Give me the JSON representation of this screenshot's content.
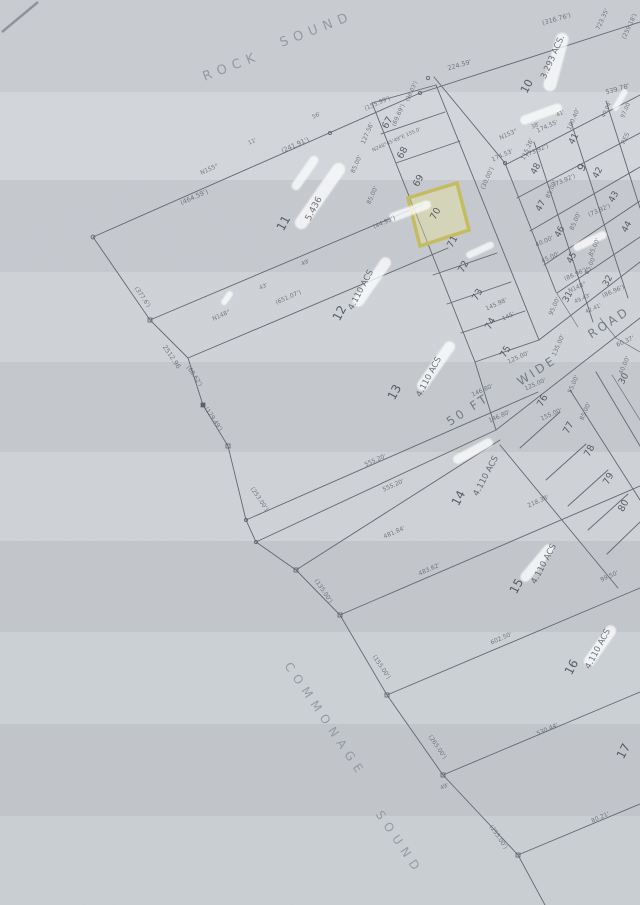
{
  "map": {
    "title": "Rock Sound subdivision survey plat (scanned)",
    "highlight": {
      "lot": "70",
      "stroke": "#c6bc5e",
      "fill": "rgba(236,230,152,0.40)"
    },
    "colors": {
      "paper": "#c9cdd2",
      "ink": "#62666e",
      "faded_ink": "#8b9198",
      "highlight": "#c6bc5e"
    },
    "labels": [
      {
        "t": "ROCK",
        "x": 233,
        "y": 70,
        "r": -21,
        "s": 13,
        "c": "water"
      },
      {
        "t": "SOUND",
        "x": 318,
        "y": 33,
        "r": -21,
        "s": 13,
        "c": "water"
      },
      {
        "t": "COMMONAGE",
        "x": 322,
        "y": 722,
        "r": 56,
        "s": 12,
        "c": "water"
      },
      {
        "t": "SOUND",
        "x": 396,
        "y": 845,
        "r": 56,
        "s": 12,
        "c": "water"
      },
      {
        "t": "11",
        "x": 287,
        "y": 225,
        "r": -62,
        "s": 12,
        "c": "lot"
      },
      {
        "t": "5.436",
        "x": 316,
        "y": 210,
        "r": -62,
        "s": 9,
        "c": "acs"
      },
      {
        "t": "12",
        "x": 343,
        "y": 315,
        "r": -62,
        "s": 12,
        "c": "lot"
      },
      {
        "t": "4.110 ACS",
        "x": 363,
        "y": 291,
        "r": -62,
        "s": 8.5,
        "c": "acs"
      },
      {
        "t": "13",
        "x": 398,
        "y": 394,
        "r": -62,
        "s": 12,
        "c": "lot"
      },
      {
        "t": "4.110 ACS",
        "x": 431,
        "y": 378,
        "r": -62,
        "s": 8.5,
        "c": "acs"
      },
      {
        "t": "14",
        "x": 462,
        "y": 500,
        "r": -62,
        "s": 12,
        "c": "lot"
      },
      {
        "t": "4.110 ACS",
        "x": 488,
        "y": 477,
        "r": -62,
        "s": 8.5,
        "c": "acs"
      },
      {
        "t": "15",
        "x": 520,
        "y": 588,
        "r": -62,
        "s": 12,
        "c": "lot"
      },
      {
        "t": "4.110 ACS",
        "x": 546,
        "y": 565,
        "r": -62,
        "s": 8.5,
        "c": "acs"
      },
      {
        "t": "16",
        "x": 575,
        "y": 669,
        "r": -62,
        "s": 12,
        "c": "lot"
      },
      {
        "t": "4.110 ACS",
        "x": 600,
        "y": 650,
        "r": -62,
        "s": 8.5,
        "c": "acs"
      },
      {
        "t": "17",
        "x": 627,
        "y": 753,
        "r": -62,
        "s": 12,
        "c": "lot"
      },
      {
        "t": "67",
        "x": 390,
        "y": 124,
        "r": -62,
        "s": 9.5,
        "c": "lot"
      },
      {
        "t": "68",
        "x": 405,
        "y": 154,
        "r": -62,
        "s": 9.5,
        "c": "lot"
      },
      {
        "t": "69",
        "x": 421,
        "y": 182,
        "r": -62,
        "s": 9.5,
        "c": "lot"
      },
      {
        "t": "70",
        "x": 438,
        "y": 215,
        "r": -62,
        "s": 9.5,
        "c": "lot"
      },
      {
        "t": "71",
        "x": 455,
        "y": 243,
        "r": -62,
        "s": 9.5,
        "c": "lot"
      },
      {
        "t": "72",
        "x": 466,
        "y": 268,
        "r": -62,
        "s": 9.5,
        "c": "lot"
      },
      {
        "t": "73",
        "x": 480,
        "y": 296,
        "r": -62,
        "s": 9.5,
        "c": "lot"
      },
      {
        "t": "74",
        "x": 493,
        "y": 325,
        "r": -62,
        "s": 9.5,
        "c": "lot"
      },
      {
        "t": "75",
        "x": 508,
        "y": 353,
        "r": -62,
        "s": 9.5,
        "c": "lot"
      },
      {
        "t": "76",
        "x": 545,
        "y": 402,
        "r": -62,
        "s": 9.5,
        "c": "lot"
      },
      {
        "t": "77",
        "x": 571,
        "y": 429,
        "r": -62,
        "s": 9.5,
        "c": "lot"
      },
      {
        "t": "78",
        "x": 592,
        "y": 452,
        "r": -62,
        "s": 9.5,
        "c": "lot"
      },
      {
        "t": "79",
        "x": 611,
        "y": 480,
        "r": -62,
        "s": 9.5,
        "c": "lot"
      },
      {
        "t": "80",
        "x": 626,
        "y": 507,
        "r": -62,
        "s": 9.5,
        "c": "lot"
      },
      {
        "t": "10",
        "x": 530,
        "y": 88,
        "r": -62,
        "s": 11,
        "c": "lot"
      },
      {
        "t": "3.293 ACS.",
        "x": 555,
        "y": 58,
        "r": -66,
        "s": 8.5,
        "c": "acs"
      },
      {
        "t": "9",
        "x": 585,
        "y": 169,
        "r": -62,
        "s": 11,
        "c": "lot"
      },
      {
        "t": "48",
        "x": 538,
        "y": 170,
        "r": -62,
        "s": 9,
        "c": "lot"
      },
      {
        "t": "41",
        "x": 576,
        "y": 140,
        "r": -62,
        "s": 9,
        "c": "lot"
      },
      {
        "t": "42",
        "x": 600,
        "y": 174,
        "r": -62,
        "s": 9,
        "c": "lot"
      },
      {
        "t": "47",
        "x": 543,
        "y": 207,
        "r": -62,
        "s": 9,
        "c": "lot"
      },
      {
        "t": "46",
        "x": 562,
        "y": 233,
        "r": -62,
        "s": 9,
        "c": "lot"
      },
      {
        "t": "45",
        "x": 574,
        "y": 259,
        "r": -62,
        "s": 9,
        "c": "lot"
      },
      {
        "t": "43",
        "x": 616,
        "y": 198,
        "r": -62,
        "s": 9,
        "c": "lot"
      },
      {
        "t": "44",
        "x": 629,
        "y": 228,
        "r": -62,
        "s": 9,
        "c": "lot"
      },
      {
        "t": "32",
        "x": 610,
        "y": 282,
        "r": -62,
        "s": 9,
        "c": "lot"
      },
      {
        "t": "31",
        "x": 570,
        "y": 298,
        "r": -62,
        "s": 9,
        "c": "lot"
      },
      {
        "t": "30",
        "x": 626,
        "y": 380,
        "r": -62,
        "s": 9,
        "c": "lot"
      },
      {
        "t": "50 FT",
        "x": 470,
        "y": 413,
        "r": -33,
        "s": 12,
        "c": "road"
      },
      {
        "t": "WIDE",
        "x": 539,
        "y": 374,
        "r": -33,
        "s": 12,
        "c": "road"
      },
      {
        "t": "ROAD",
        "x": 611,
        "y": 326,
        "r": -33,
        "s": 12,
        "c": "road"
      },
      {
        "t": "(464.59')",
        "x": 195,
        "y": 199,
        "r": -24,
        "s": 6.5,
        "c": "dim"
      },
      {
        "t": "N155°",
        "x": 210,
        "y": 171,
        "r": -24,
        "s": 6,
        "c": "dim"
      },
      {
        "t": "(241.91')",
        "x": 296,
        "y": 147,
        "r": -24,
        "s": 6.5,
        "c": "dim"
      },
      {
        "t": "11'",
        "x": 253,
        "y": 143,
        "r": -24,
        "s": 5.5,
        "c": "dim"
      },
      {
        "t": "56'",
        "x": 317,
        "y": 117,
        "r": -24,
        "s": 5.5,
        "c": "dim"
      },
      {
        "t": "224.59'",
        "x": 460,
        "y": 67,
        "r": -16,
        "s": 6.5,
        "c": "dim"
      },
      {
        "t": "(316.76')",
        "x": 557,
        "y": 21,
        "r": -16,
        "s": 6.5,
        "c": "dim"
      },
      {
        "t": "723.35'",
        "x": 604,
        "y": 20,
        "r": -65,
        "s": 6,
        "c": "dim"
      },
      {
        "t": "(259.18')",
        "x": 631,
        "y": 27,
        "r": -65,
        "s": 6,
        "c": "dim"
      },
      {
        "t": "(155.99')",
        "x": 378,
        "y": 105,
        "r": -24,
        "s": 6,
        "c": "dim"
      },
      {
        "t": "(69.69')",
        "x": 400,
        "y": 116,
        "r": -66,
        "s": 6,
        "c": "dim"
      },
      {
        "t": "(36.03')",
        "x": 413,
        "y": 92,
        "r": -66,
        "s": 5.5,
        "c": "dim"
      },
      {
        "t": "127.56'",
        "x": 369,
        "y": 134,
        "r": -66,
        "s": 6,
        "c": "dim"
      },
      {
        "t": "N248°45'49\"E 155.0'",
        "x": 397,
        "y": 141,
        "r": -24,
        "s": 5,
        "c": "dim"
      },
      {
        "t": "85.00'",
        "x": 358,
        "y": 165,
        "r": -66,
        "s": 6,
        "c": "dim"
      },
      {
        "t": "85.00'",
        "x": 374,
        "y": 196,
        "r": -66,
        "s": 6,
        "c": "dim"
      },
      {
        "t": "(44.93')",
        "x": 385,
        "y": 224,
        "r": -24,
        "s": 6,
        "c": "dim"
      },
      {
        "t": "(30.00')",
        "x": 489,
        "y": 179,
        "r": -66,
        "s": 6,
        "c": "dim"
      },
      {
        "t": "145.98'",
        "x": 497,
        "y": 306,
        "r": -24,
        "s": 6,
        "c": "dim"
      },
      {
        "t": "145'",
        "x": 509,
        "y": 318,
        "r": -24,
        "s": 6,
        "c": "dim"
      },
      {
        "t": "N148°",
        "x": 222,
        "y": 317,
        "r": -24,
        "s": 6,
        "c": "dim"
      },
      {
        "t": "43'",
        "x": 264,
        "y": 288,
        "r": -24,
        "s": 5.5,
        "c": "dim"
      },
      {
        "t": "49'",
        "x": 306,
        "y": 264,
        "r": -24,
        "s": 5.5,
        "c": "dim"
      },
      {
        "t": "(651.07')",
        "x": 289,
        "y": 299,
        "r": -24,
        "s": 6,
        "c": "dim"
      },
      {
        "t": "(377.6')",
        "x": 141,
        "y": 298,
        "r": 56,
        "s": 6,
        "c": "dim"
      },
      {
        "t": "2512.96",
        "x": 170,
        "y": 358,
        "r": 56,
        "s": 6.5,
        "c": "dim"
      },
      {
        "t": "(68.62')",
        "x": 193,
        "y": 377,
        "r": 56,
        "s": 6,
        "c": "dim"
      },
      {
        "t": "(129.49')",
        "x": 212,
        "y": 420,
        "r": 56,
        "s": 6,
        "c": "dim"
      },
      {
        "t": "(253.00')",
        "x": 258,
        "y": 500,
        "r": 56,
        "s": 6,
        "c": "dim"
      },
      {
        "t": "(135.00')",
        "x": 322,
        "y": 592,
        "r": 56,
        "s": 6,
        "c": "dim"
      },
      {
        "t": "(155.00')",
        "x": 380,
        "y": 668,
        "r": 56,
        "s": 6,
        "c": "dim"
      },
      {
        "t": "(265.00')",
        "x": 436,
        "y": 748,
        "r": 56,
        "s": 6,
        "c": "dim"
      },
      {
        "t": "49'",
        "x": 445,
        "y": 788,
        "r": -24,
        "s": 5.5,
        "c": "dim"
      },
      {
        "t": "(255.00')",
        "x": 497,
        "y": 838,
        "r": 56,
        "s": 6,
        "c": "dim"
      },
      {
        "t": "539.78'",
        "x": 618,
        "y": 91,
        "r": -16,
        "s": 6.5,
        "c": "dim"
      },
      {
        "t": "174.55'",
        "x": 548,
        "y": 128,
        "r": -24,
        "s": 6,
        "c": "dim"
      },
      {
        "t": "N153°",
        "x": 509,
        "y": 136,
        "r": -24,
        "s": 6,
        "c": "dim"
      },
      {
        "t": "38'",
        "x": 536,
        "y": 127,
        "r": -24,
        "s": 5.5,
        "c": "dim"
      },
      {
        "t": "41'",
        "x": 561,
        "y": 115,
        "r": -24,
        "s": 5.5,
        "c": "dim"
      },
      {
        "t": "174.53'",
        "x": 503,
        "y": 157,
        "r": -24,
        "s": 6,
        "c": "dim"
      },
      {
        "t": "115.26'",
        "x": 529,
        "y": 150,
        "r": -66,
        "s": 6,
        "c": "dim"
      },
      {
        "t": "100.40'",
        "x": 575,
        "y": 120,
        "r": -66,
        "s": 6,
        "c": "dim"
      },
      {
        "t": "40.04'",
        "x": 608,
        "y": 110,
        "r": -66,
        "s": 5.5,
        "c": "dim"
      },
      {
        "t": "97.00",
        "x": 627,
        "y": 111,
        "r": -66,
        "s": 5.5,
        "c": "dim"
      },
      {
        "t": "RES",
        "x": 627,
        "y": 139,
        "r": -66,
        "s": 6,
        "c": "dim"
      },
      {
        "t": "(73.92')",
        "x": 538,
        "y": 152,
        "r": -24,
        "s": 6,
        "c": "dim"
      },
      {
        "t": "(73.92')",
        "x": 565,
        "y": 182,
        "r": -24,
        "s": 6,
        "c": "dim"
      },
      {
        "t": "(73.92')",
        "x": 600,
        "y": 212,
        "r": -24,
        "s": 6,
        "c": "dim"
      },
      {
        "t": "85.00'",
        "x": 553,
        "y": 190,
        "r": -66,
        "s": 6,
        "c": "dim"
      },
      {
        "t": "85.00'",
        "x": 577,
        "y": 222,
        "r": -66,
        "s": 6,
        "c": "dim"
      },
      {
        "t": "85.00'",
        "x": 596,
        "y": 248,
        "r": -66,
        "s": 6,
        "c": "dim"
      },
      {
        "t": "40.00'",
        "x": 545,
        "y": 243,
        "r": -24,
        "s": 6,
        "c": "dim"
      },
      {
        "t": "45.00'",
        "x": 551,
        "y": 259,
        "r": -24,
        "s": 6,
        "c": "dim"
      },
      {
        "t": "85.00'",
        "x": 592,
        "y": 266,
        "r": -66,
        "s": 6,
        "c": "dim"
      },
      {
        "t": "(86.96')",
        "x": 576,
        "y": 276,
        "r": -24,
        "s": 6,
        "c": "dim"
      },
      {
        "t": "(86.96')",
        "x": 614,
        "y": 293,
        "r": -24,
        "s": 6,
        "c": "dim"
      },
      {
        "t": "N148°",
        "x": 578,
        "y": 289,
        "r": -24,
        "s": 6,
        "c": "dim"
      },
      {
        "t": "49.43'",
        "x": 583,
        "y": 300,
        "r": -24,
        "s": 5.5,
        "c": "dim"
      },
      {
        "t": "42.41'",
        "x": 594,
        "y": 310,
        "r": -24,
        "s": 5.5,
        "c": "dim"
      },
      {
        "t": "95.00'",
        "x": 556,
        "y": 307,
        "r": -66,
        "s": 6,
        "c": "dim"
      },
      {
        "t": "60.37'",
        "x": 626,
        "y": 343,
        "r": -24,
        "s": 6,
        "c": "dim"
      },
      {
        "t": "125.00'",
        "x": 519,
        "y": 359,
        "r": -24,
        "s": 6,
        "c": "dim"
      },
      {
        "t": "125.00'",
        "x": 536,
        "y": 386,
        "r": -24,
        "s": 6,
        "c": "dim"
      },
      {
        "t": "155.00'",
        "x": 552,
        "y": 416,
        "r": -24,
        "s": 6,
        "c": "dim"
      },
      {
        "t": "85.00'",
        "x": 587,
        "y": 412,
        "r": -66,
        "s": 6,
        "c": "dim"
      },
      {
        "t": "135.00'",
        "x": 560,
        "y": 346,
        "r": -66,
        "s": 6,
        "c": "dim"
      },
      {
        "t": "55.00'",
        "x": 575,
        "y": 385,
        "r": -66,
        "s": 6,
        "c": "dim"
      },
      {
        "t": "40.00'",
        "x": 626,
        "y": 366,
        "r": -66,
        "s": 6,
        "c": "dim"
      },
      {
        "t": "146.80'",
        "x": 483,
        "y": 392,
        "r": -24,
        "s": 6,
        "c": "dim"
      },
      {
        "t": "146.80'",
        "x": 500,
        "y": 418,
        "r": -24,
        "s": 6,
        "c": "dim"
      },
      {
        "t": "218.38'",
        "x": 539,
        "y": 503,
        "r": -24,
        "s": 6,
        "c": "dim"
      },
      {
        "t": "555.20'",
        "x": 376,
        "y": 462,
        "r": -24,
        "s": 6,
        "c": "dim"
      },
      {
        "t": "555.20'",
        "x": 394,
        "y": 487,
        "r": -24,
        "s": 6,
        "c": "dim"
      },
      {
        "t": "481.84'",
        "x": 395,
        "y": 534,
        "r": -24,
        "s": 6,
        "c": "dim"
      },
      {
        "t": "483.62'",
        "x": 430,
        "y": 571,
        "r": -24,
        "s": 6,
        "c": "dim"
      },
      {
        "t": "99.50'",
        "x": 610,
        "y": 578,
        "r": -24,
        "s": 6,
        "c": "dim"
      },
      {
        "t": "602.50'",
        "x": 502,
        "y": 640,
        "r": -24,
        "s": 6,
        "c": "dim"
      },
      {
        "t": "530.44'",
        "x": 548,
        "y": 731,
        "r": -24,
        "s": 6,
        "c": "dim"
      },
      {
        "t": "80.21'",
        "x": 601,
        "y": 819,
        "r": -24,
        "s": 6,
        "c": "dim"
      }
    ]
  }
}
